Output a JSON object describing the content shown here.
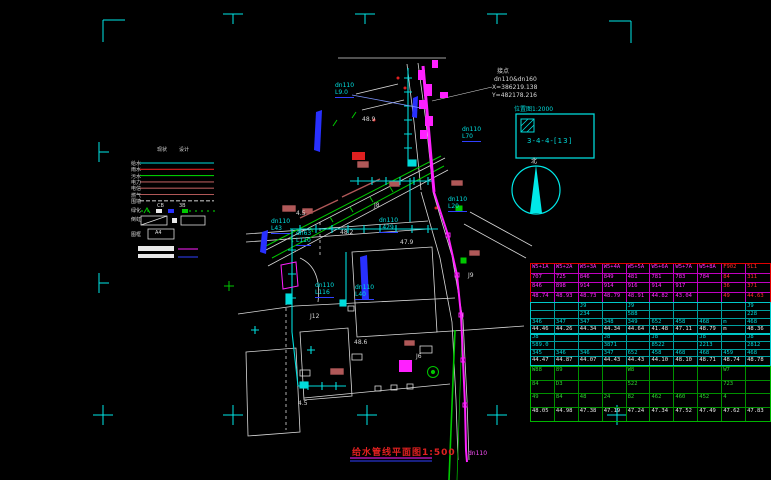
{
  "drawing": {
    "title": "给水管线平面图1:500",
    "north_label": "北",
    "detail_box": {
      "label": "位置图1:2000",
      "ref": "3-4-4-[13]"
    },
    "connection_note": {
      "line1": "接点",
      "line2": "dn110&dn160",
      "line3": "X=386219.138",
      "line4": "Y=482178.216"
    }
  },
  "legend": {
    "header_existing": "现状",
    "header_design": "设计",
    "a4_label": "A4",
    "rows": [
      {
        "label": "给水",
        "color": "#00dcdc",
        "dash": ""
      },
      {
        "label": "雨水",
        "color": "#e02020",
        "dash": ""
      },
      {
        "label": "污水",
        "color": "#00c800",
        "dash": ""
      },
      {
        "label": "电力",
        "color": "#b05858",
        "dash": ""
      },
      {
        "label": "电信",
        "color": "#b05858",
        "dash": ""
      },
      {
        "label": "燃气",
        "color": "#b05858",
        "dash": ""
      },
      {
        "label": "围墙",
        "color": "#bbbbbb",
        "dash": "4 2"
      }
    ],
    "row_extra_labels": [
      {
        "t": "绿化",
        "x": 131,
        "y": 207
      },
      {
        "t": "倒虹",
        "x": 131,
        "y": 216
      },
      {
        "t": "图框",
        "x": 131,
        "y": 231
      },
      {
        "t": "CB",
        "x": 157,
        "y": 203
      },
      {
        "t": "3B",
        "x": 179,
        "y": 203
      }
    ]
  },
  "map": {
    "pipe_labels": [
      {
        "d": "dn110",
        "l": "L9.0",
        "x": 335,
        "y": 83
      },
      {
        "d": "dn110",
        "l": "L70",
        "x": 462,
        "y": 127
      },
      {
        "d": "dn110",
        "l": "L43",
        "x": 271,
        "y": 219
      },
      {
        "d": "dn110",
        "l": "L429",
        "x": 379,
        "y": 218
      },
      {
        "d": "dn63",
        "l": "L110",
        "x": 296,
        "y": 231
      },
      {
        "d": "dn110",
        "l": "L116",
        "x": 315,
        "y": 283
      },
      {
        "d": "dn110",
        "l": "L40",
        "x": 355,
        "y": 285
      },
      {
        "d": "dn110",
        "l": "L20",
        "x": 448,
        "y": 197
      }
    ],
    "spot_labels": [
      {
        "t": "4.5",
        "x": 296,
        "y": 211
      },
      {
        "t": "J8",
        "x": 374,
        "y": 203
      },
      {
        "t": "48.2",
        "x": 340,
        "y": 230
      },
      {
        "t": "47.9",
        "x": 400,
        "y": 240
      },
      {
        "t": "J12",
        "x": 310,
        "y": 314
      },
      {
        "t": "48.6",
        "x": 354,
        "y": 340
      },
      {
        "t": "4.5",
        "x": 298,
        "y": 401
      },
      {
        "t": "J6",
        "x": 416,
        "y": 354
      },
      {
        "t": "48.9",
        "x": 362,
        "y": 117
      },
      {
        "t": "J9",
        "x": 468,
        "y": 273
      },
      {
        "t": "dn110",
        "x": 468,
        "y": 451,
        "c": "#ff50ff"
      }
    ]
  },
  "table": {
    "sections": [
      {
        "top": 263,
        "height": 38,
        "border": "#e00000",
        "grid": "#c000c0",
        "code_color": "#ff30ff",
        "val_color": "#ff30ff",
        "alt_cols": [
          8,
          9
        ],
        "alt_color": "#ff3030",
        "rows": [
          [
            "W5+1A",
            "W5+2A",
            "W5+3A",
            "W5+4A",
            "W5+5A",
            "W5+6A",
            "W5+7A",
            "W5+8A",
            "F902",
            "5L1"
          ],
          [
            "707",
            "725",
            "846",
            "849",
            "481",
            "781",
            "783",
            "784",
            "84",
            "311"
          ],
          [
            "846",
            "898",
            "914",
            "914",
            "916",
            "914",
            "917",
            "",
            "36",
            "371"
          ],
          [
            "48.74",
            "48.93",
            "48.73",
            "48.79",
            "48.91",
            "44.82",
            "43.04",
            "",
            "49",
            "44.63"
          ]
        ]
      },
      {
        "top": 302,
        "height": 31,
        "border": "#00c8c8",
        "grid": "#00a0a0",
        "code_color": "#00d8d8",
        "val_color": "#e8e8e8",
        "rows": [
          [
            "",
            "",
            "J9",
            "",
            "J9",
            "",
            "",
            "",
            "",
            "J9"
          ],
          [
            "",
            "",
            "234",
            "",
            "588",
            "",
            "",
            "",
            "",
            "228"
          ],
          [
            "346",
            "347",
            "347",
            "348",
            "349",
            "652",
            "458",
            "468",
            "m",
            "468"
          ],
          [
            "44.46",
            "44.26",
            "44.34",
            "44.34",
            "44.64",
            "41.48",
            "47.11",
            "48.79",
            "m",
            "48.36"
          ]
        ]
      },
      {
        "top": 333,
        "height": 31,
        "border": "#00c8c8",
        "grid": "#00a0a0",
        "code_color": "#00d8d8",
        "val_color": "#e8e8e8",
        "rows": [
          [
            "J8",
            "",
            "",
            "J8",
            "",
            "J8",
            "",
            "J8",
            "",
            "J8"
          ],
          [
            "589.0",
            "",
            "",
            "3871",
            "",
            "8522",
            "",
            "2213",
            "",
            "2812"
          ],
          [
            "345",
            "346",
            "346",
            "347",
            "652",
            "458",
            "468",
            "468",
            "459",
            "468"
          ],
          [
            "44.47",
            "44.87",
            "44.07",
            "44.43",
            "44.43",
            "44.10",
            "48.10",
            "48.71",
            "48.74",
            "48.78"
          ]
        ]
      },
      {
        "top": 366,
        "height": 54,
        "border": "#00b400",
        "grid": "#009000",
        "code_color": "#30d030",
        "val_color": "#e8e8e8",
        "rows": [
          [
            "W88",
            "89",
            "",
            "",
            "W8",
            "",
            "",
            "",
            "W7",
            ""
          ],
          [
            "84",
            "D3",
            "",
            "",
            "522",
            "",
            "",
            "",
            "723",
            ""
          ],
          [
            "49",
            "84",
            "48",
            "24",
            "82",
            "462",
            "460",
            "452",
            "4",
            ""
          ],
          [
            "48.05",
            "44.98",
            "47.38",
            "47.19",
            "47.24",
            "47.34",
            "47.52",
            "47.49",
            "47.62",
            "47.83"
          ]
        ]
      }
    ]
  }
}
